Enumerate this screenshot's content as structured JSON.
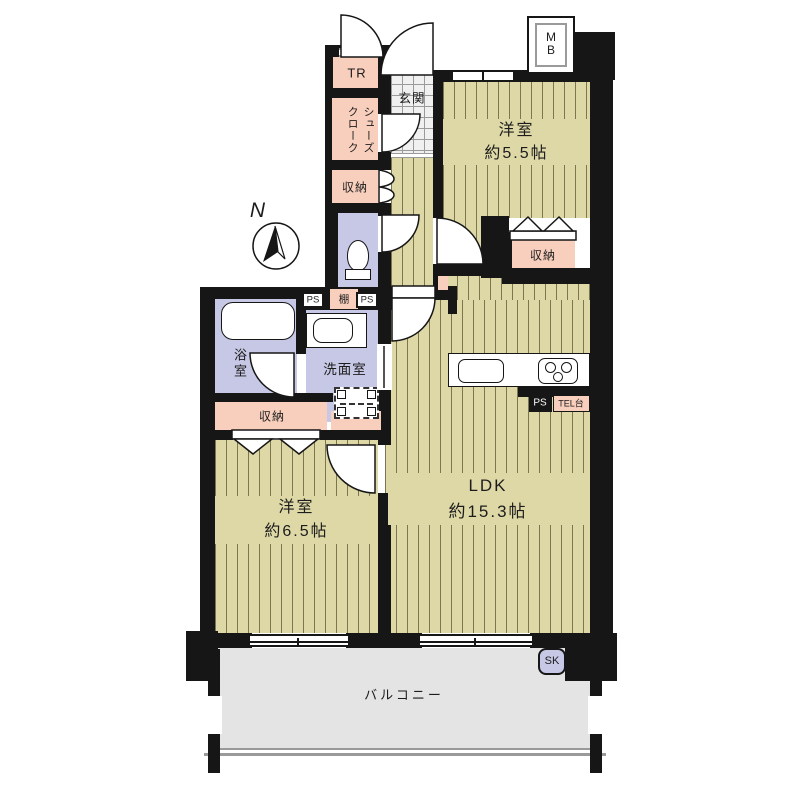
{
  "colors": {
    "wall": "#161616",
    "tatami": "#ded8a7",
    "tatami-line": "#7b7550",
    "lavender": "#c7c8e5",
    "pink": "#f8cfbd",
    "tile": "#f0f0f0",
    "balcony": "#e4e4e4"
  },
  "rooms": {
    "trunk": {
      "label": "TR"
    },
    "shoes_closet": {
      "line1": "シューズ",
      "line2": "クローク"
    },
    "entrance": {
      "label": "玄関"
    },
    "bedroom1": {
      "label": "洋室",
      "size": "約5.5帖"
    },
    "bedroom2": {
      "label": "洋室",
      "size": "約6.5帖"
    },
    "ldk": {
      "label": "LDK",
      "size": "約15.3帖"
    },
    "bath": {
      "label": "浴室"
    },
    "washroom": {
      "label": "洗面室"
    },
    "balcony": {
      "label": "バルコニー"
    }
  },
  "storages": {
    "hall": "収納",
    "bedroom1": "収納",
    "bath_side": "収納"
  },
  "small": {
    "mb": "MB",
    "shelf": "棚",
    "ps": "PS",
    "tel": "TEL台",
    "sk": "SK",
    "compass": "N"
  }
}
